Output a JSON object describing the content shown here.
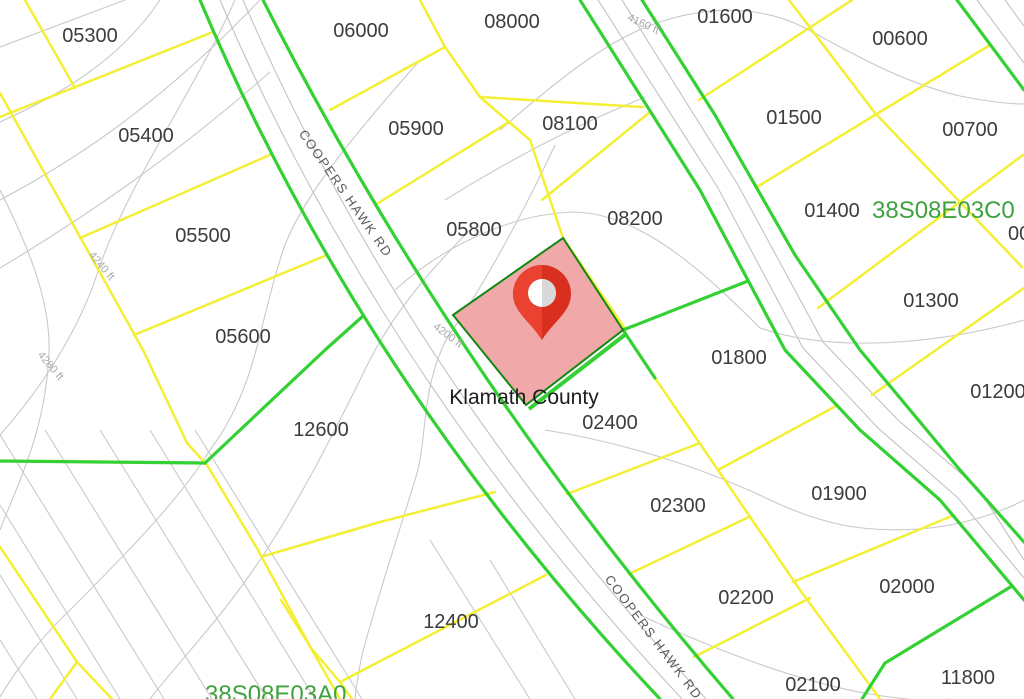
{
  "map": {
    "county": {
      "text": "Klamath County"
    },
    "road": {
      "name": "COOPERS HAWK RD"
    },
    "township_labels": [
      {
        "text": "38S08E03C0"
      },
      {
        "text": "38S08E03A0"
      }
    ],
    "contour_labels": [
      {
        "text": "4240 ft"
      },
      {
        "text": "4280 ft"
      },
      {
        "text": "4200 ft"
      },
      {
        "text": "4160 ft"
      }
    ],
    "parcels": [
      {
        "id": "05300"
      },
      {
        "id": "06000"
      },
      {
        "id": "08000"
      },
      {
        "id": "01600"
      },
      {
        "id": "00600"
      },
      {
        "id": "05400"
      },
      {
        "id": "05900"
      },
      {
        "id": "08100"
      },
      {
        "id": "01500"
      },
      {
        "id": "00700"
      },
      {
        "id": "05500"
      },
      {
        "id": "05800"
      },
      {
        "id": "08200"
      },
      {
        "id": "01400"
      },
      {
        "id": "01300"
      },
      {
        "id": "05600"
      },
      {
        "id": "01800"
      },
      {
        "id": "01200"
      },
      {
        "id": "12600"
      },
      {
        "id": "02400"
      },
      {
        "id": "01900"
      },
      {
        "id": "02300"
      },
      {
        "id": "02200"
      },
      {
        "id": "02000"
      },
      {
        "id": "12400"
      },
      {
        "id": "02100"
      },
      {
        "id": "11800"
      },
      {
        "id": "00"
      }
    ],
    "highlighted_parcel": {
      "marker": "location-pin",
      "fill": "#f0a8a8",
      "border": "#128812"
    },
    "colors": {
      "parcel_line_yellow": "#f3ef35",
      "boundary_green": "#33d133",
      "contour_gray": "#c9c9c9",
      "road_casing_gray": "#c2c2c2",
      "highlight_fill": "#f0a8a8",
      "highlight_border": "#128812",
      "pin_red_light": "#ea4130",
      "pin_red_dark": "#d92f1e",
      "parcel_text": "#3c3c3c",
      "township_text_green": "#3ea23e"
    }
  }
}
